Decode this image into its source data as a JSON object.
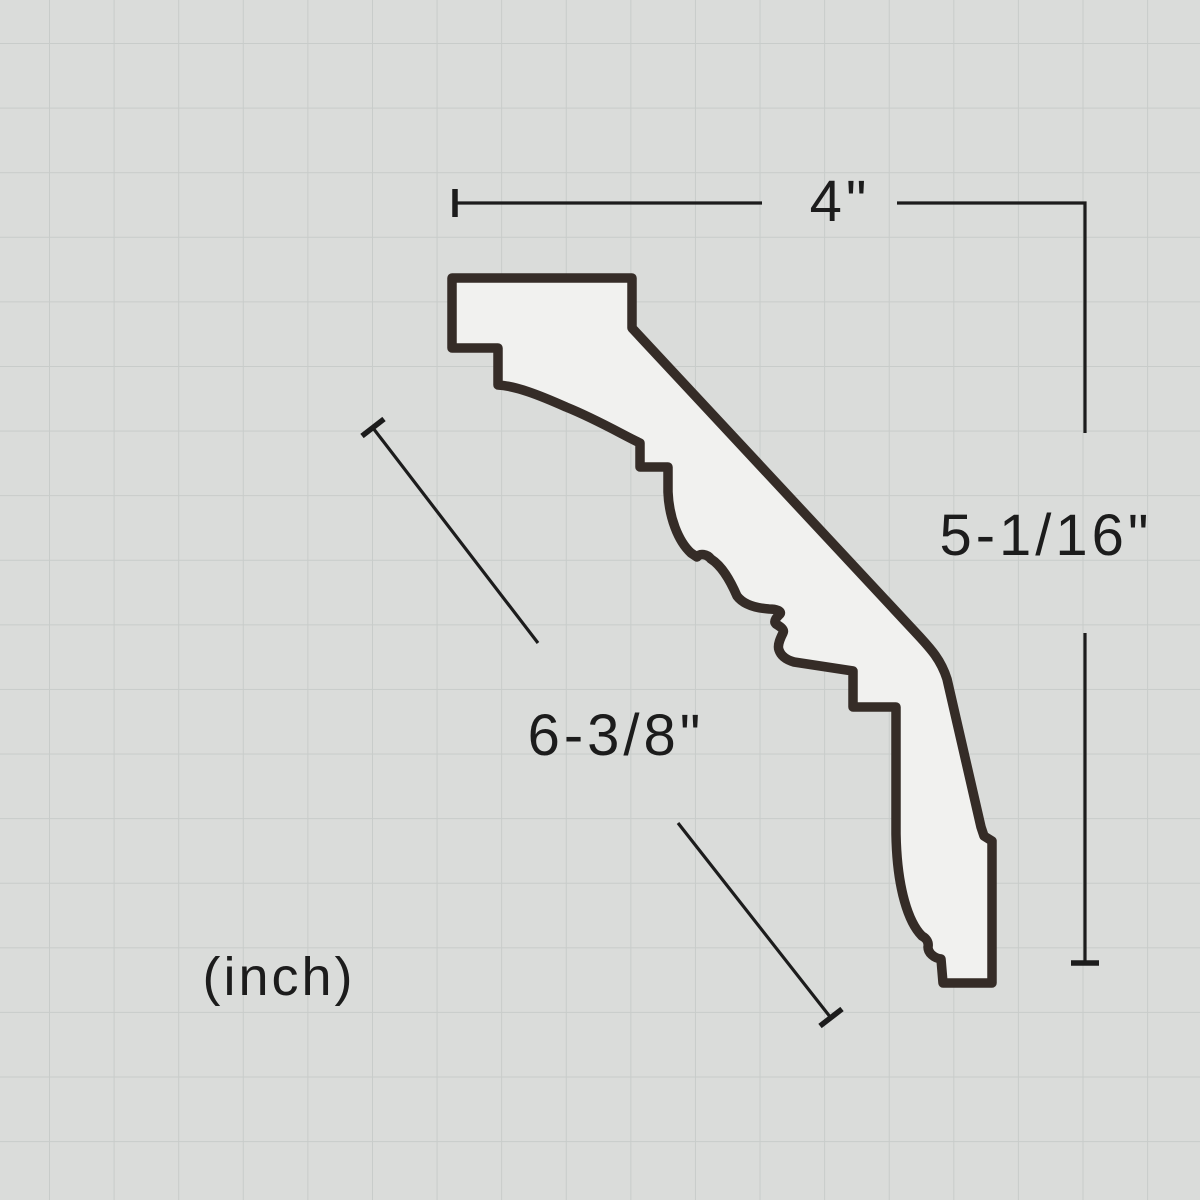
{
  "diagram": {
    "type": "crown-molding-profile-cross-section",
    "labels": {
      "top_width": "4\"",
      "right_height": "5-1/16\"",
      "diagonal_face": "6-3/8\"",
      "units": "(inch)"
    },
    "dimensions": {
      "top_width_inches": "4",
      "right_height_inches": "5-1/16",
      "diagonal_face_inches": "6-3/8"
    },
    "colors": {
      "background": "#dadcda",
      "grid_line": "#c8ccca",
      "profile_fill": "#f1f1ef",
      "profile_stroke": "#352c27",
      "dimension_color": "#1c1c1c"
    }
  }
}
